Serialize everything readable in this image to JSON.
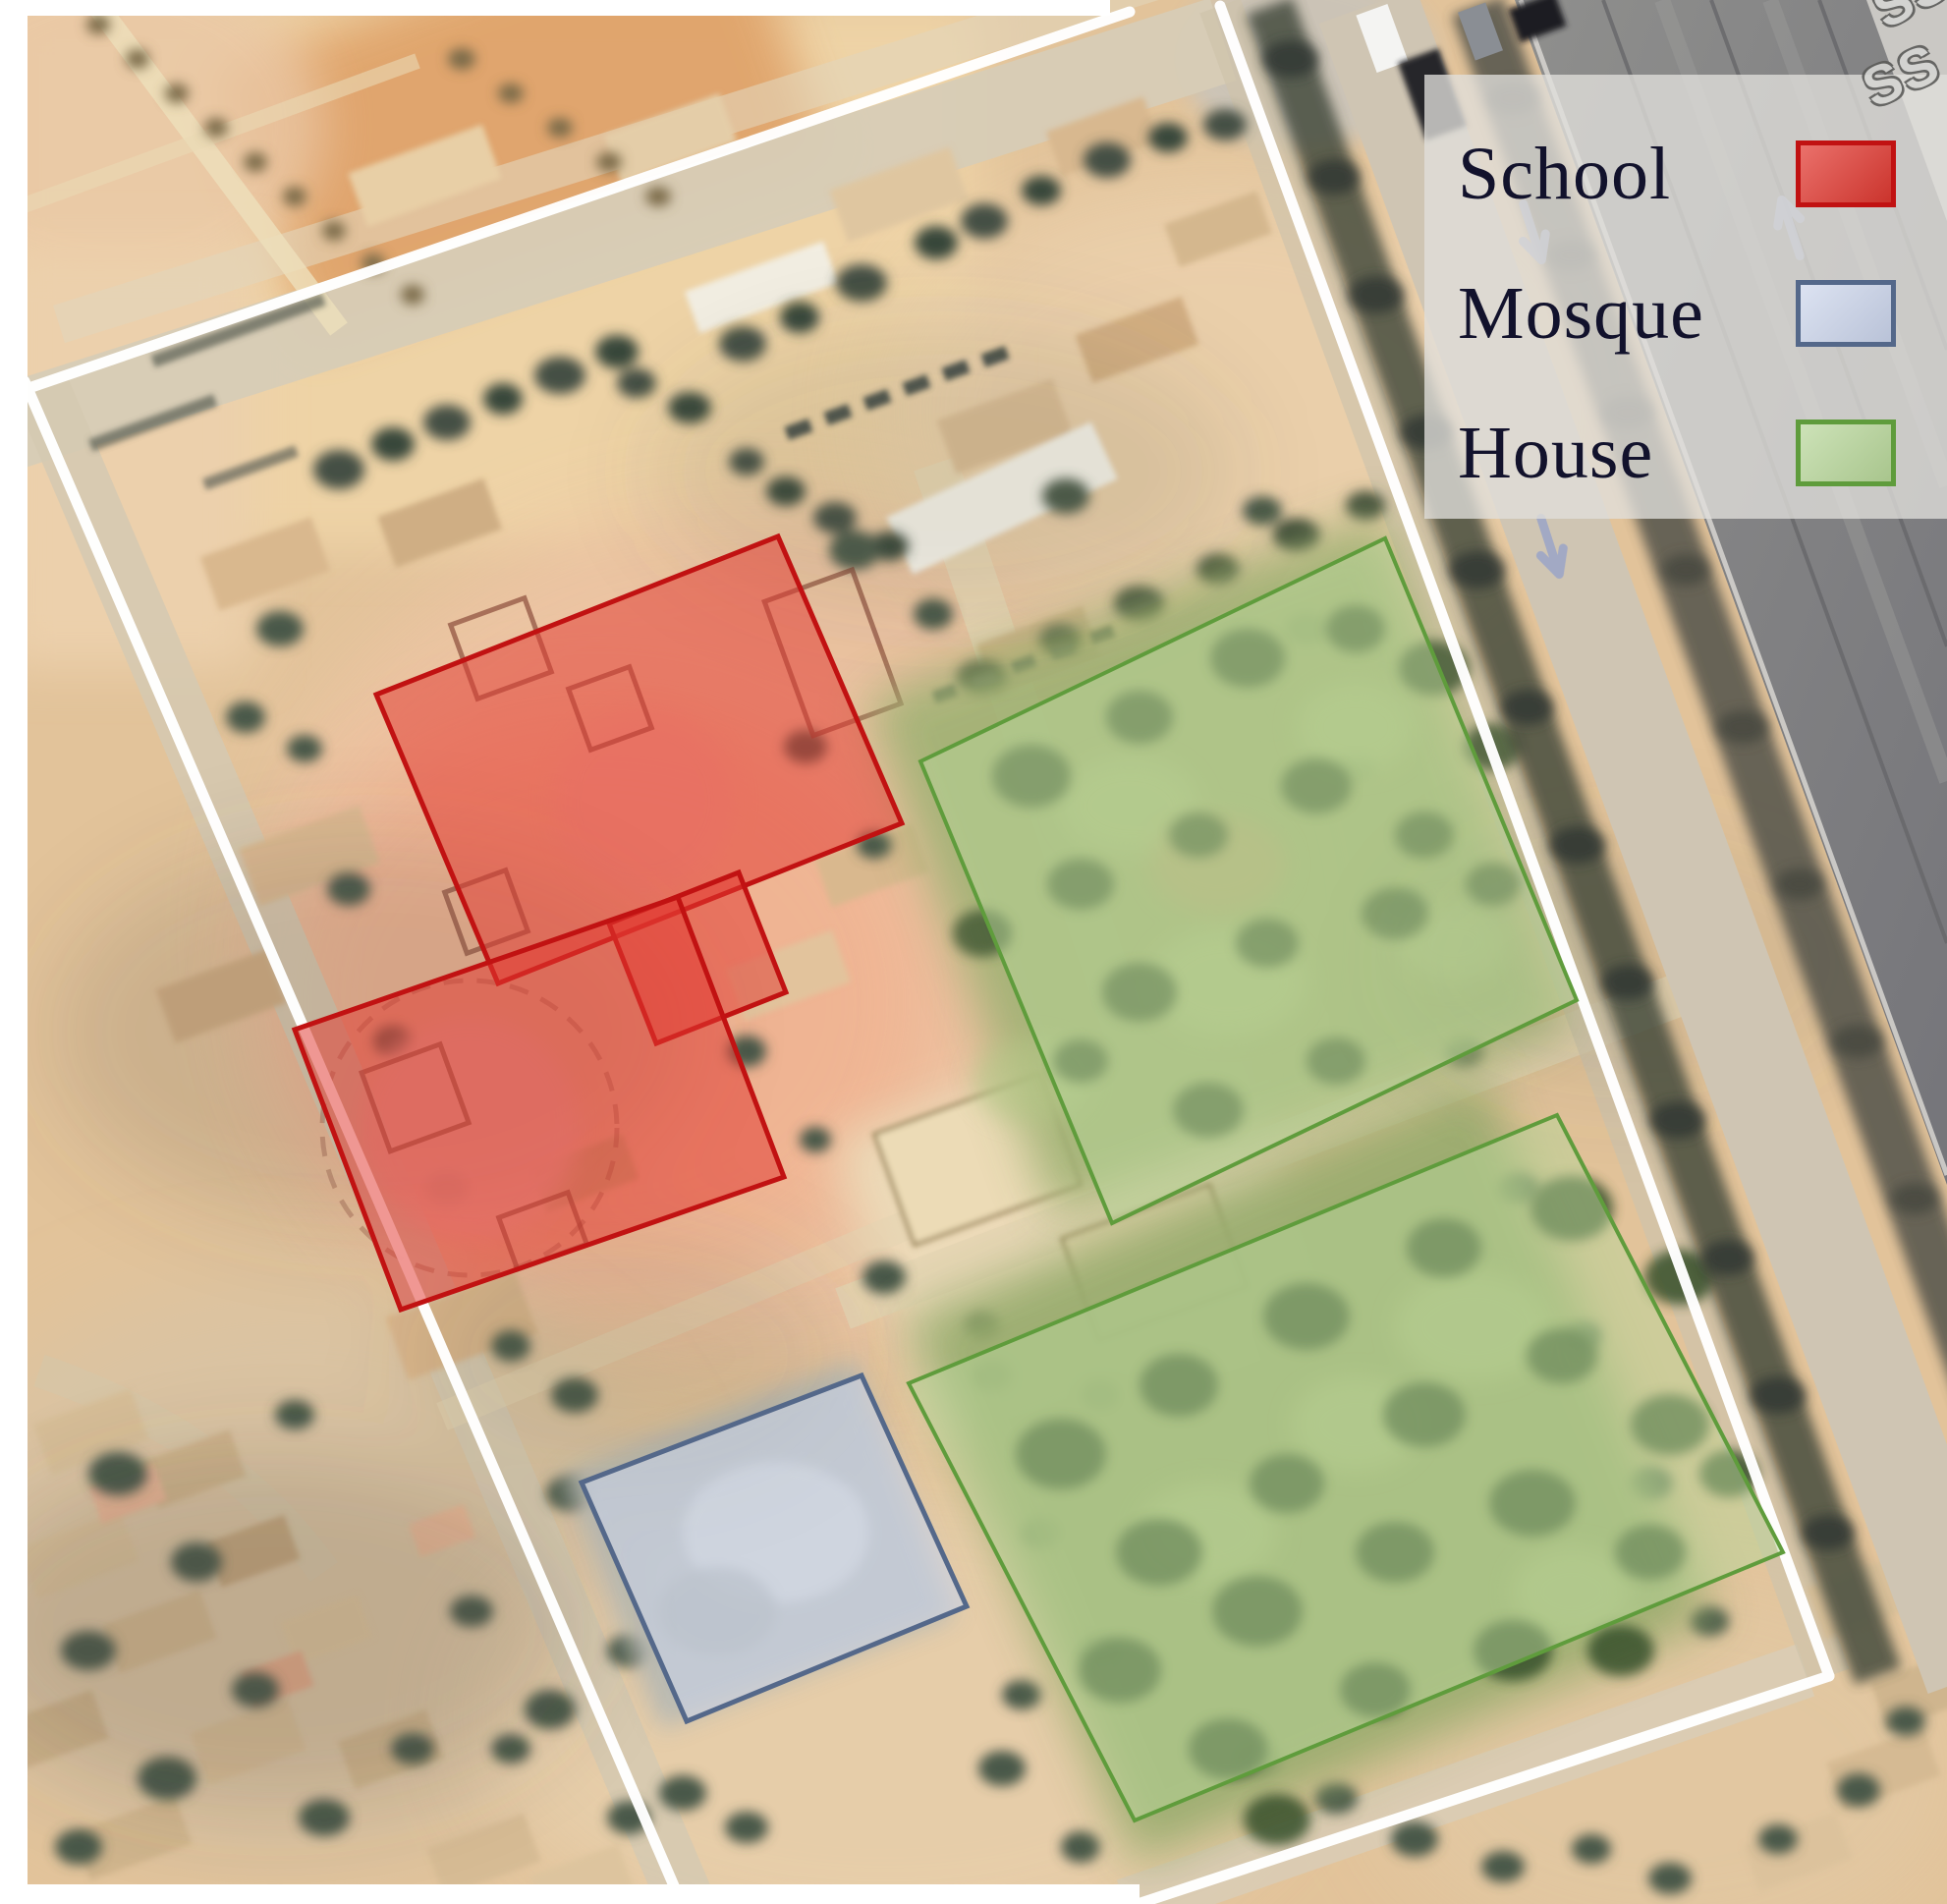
{
  "legend": {
    "items": [
      {
        "key": "school",
        "label": "School",
        "color": "#e23a32",
        "border": "#c11212"
      },
      {
        "key": "mosque",
        "label": "Mosque",
        "color": "#c9d3ea",
        "border": "#54688a"
      },
      {
        "key": "house",
        "label": "House",
        "color": "#b7d699",
        "border": "#5f9c3c"
      }
    ]
  },
  "watermark": {
    "text": "SS"
  }
}
